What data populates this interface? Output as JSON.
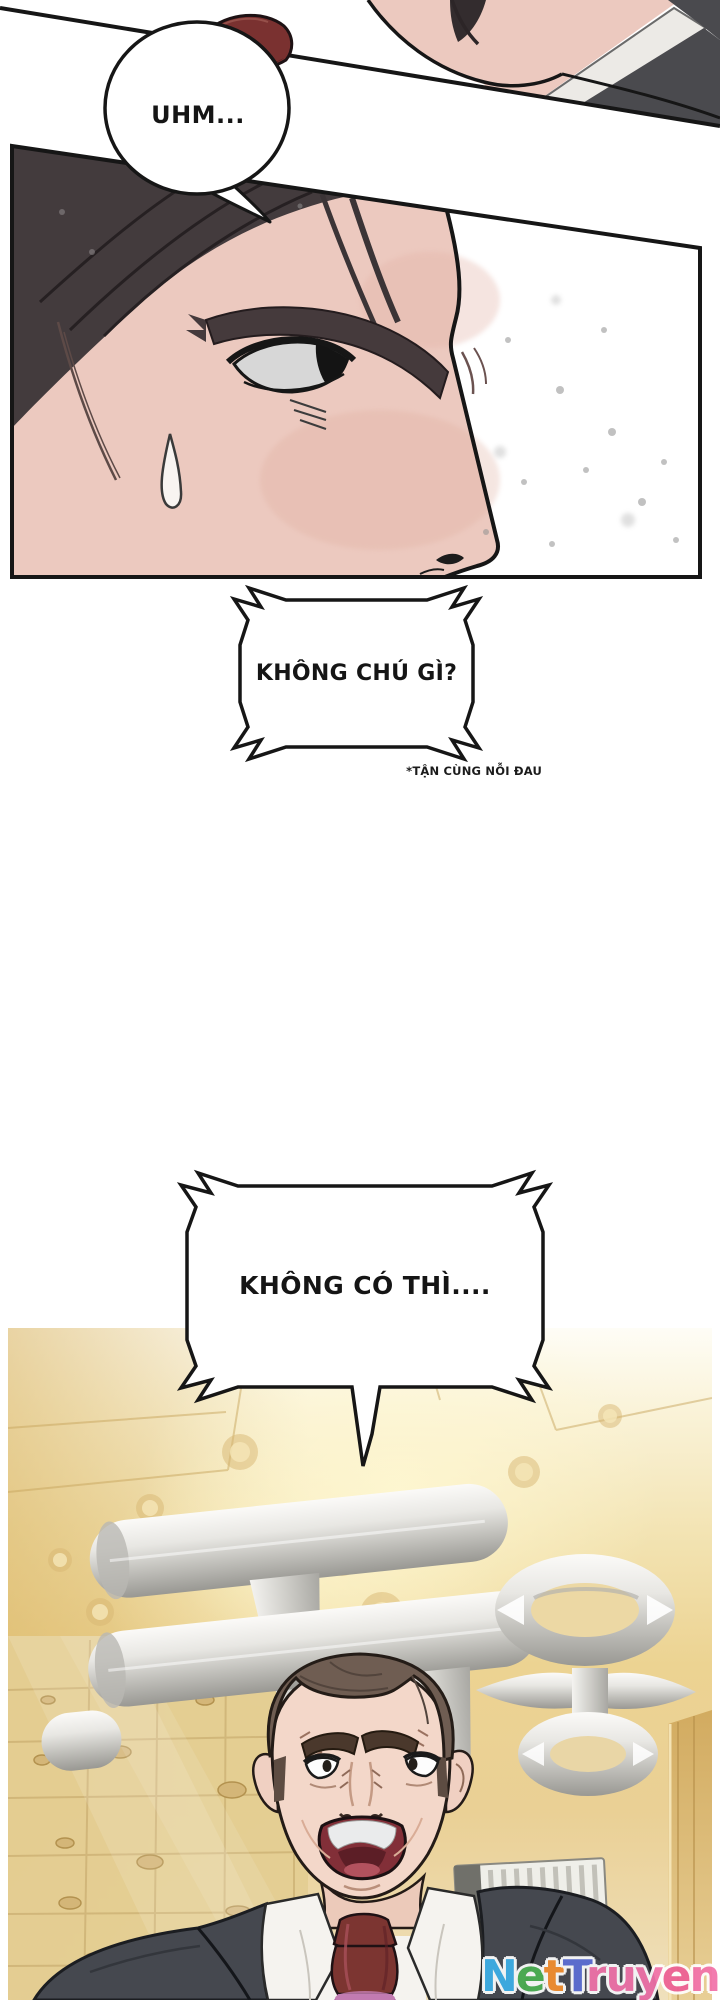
{
  "speech": {
    "bubble1": "UHM...",
    "box1": "KHÔNG CHÚ GÌ?",
    "footnote": "*TẬN CÙNG NỖI ĐAU",
    "bubble2": "KHÔNG CÓ THÌ...."
  },
  "watermark": {
    "text": "NetTruyen",
    "letters": [
      {
        "char": "N",
        "color": "#3db0e8"
      },
      {
        "char": "e",
        "color": "#4cb153"
      },
      {
        "char": "t",
        "color": "#f5902f"
      },
      {
        "char": "T",
        "color": "#5d6fd6"
      },
      {
        "char": "r",
        "color": "#f272aa"
      },
      {
        "char": "u",
        "color": "#f272aa"
      },
      {
        "char": "y",
        "color": "#f272aa"
      },
      {
        "char": "e",
        "color": "#ed5f95"
      },
      {
        "char": "n",
        "color": "#f272aa"
      }
    ]
  },
  "colors": {
    "ink": "#161616",
    "skin": "#ecc9bf",
    "hair": "#433b3d",
    "jacket": "#4a4a4e",
    "tie": "#7a3130",
    "suit": "#45484f",
    "tie2": "#7c3531",
    "vault_gold": "#ecd392",
    "metal_light": "#fbfaf8",
    "metal_dark": "#999893"
  }
}
